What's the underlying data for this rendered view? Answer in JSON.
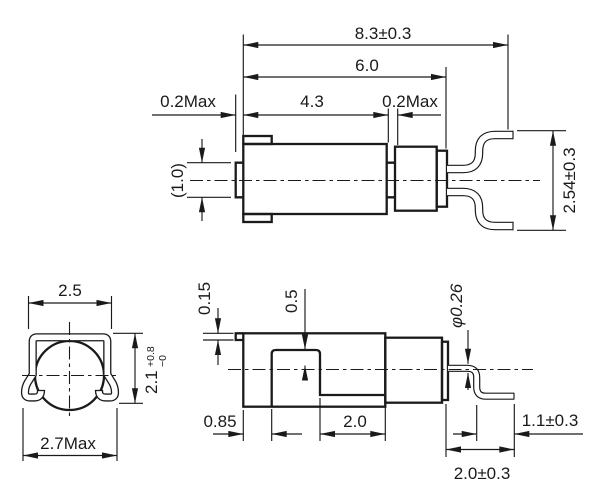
{
  "drawing": {
    "colors": {
      "line": "#1a1a1a",
      "background": "#ffffff"
    },
    "side_view": {
      "dims": {
        "overall_length": "8.3±0.3",
        "cap_length": "6.0",
        "body_length": "4.3",
        "left_protrusion_max": "0.2Max",
        "cap_gap_max": "0.2Max",
        "shaft_diameter_ref": "(1.0)",
        "lead_pitch": "2.54±0.3"
      }
    },
    "front_view": {
      "dims": {
        "clip_width": "2.5",
        "clip_height": "2.1",
        "clip_height_tol_plus": "+0.8",
        "clip_height_tol_minus": "−0",
        "overall_width_max": "2.7Max"
      }
    },
    "bottom_view": {
      "dims": {
        "seam_thickness": "0.15",
        "window_offset": "0.5",
        "left_offset": "0.85",
        "window_length": "2.0",
        "lead_diameter": "φ0.26",
        "lead_foot_length": "1.1±0.3",
        "lead_extension": "2.0±0.3"
      }
    }
  }
}
